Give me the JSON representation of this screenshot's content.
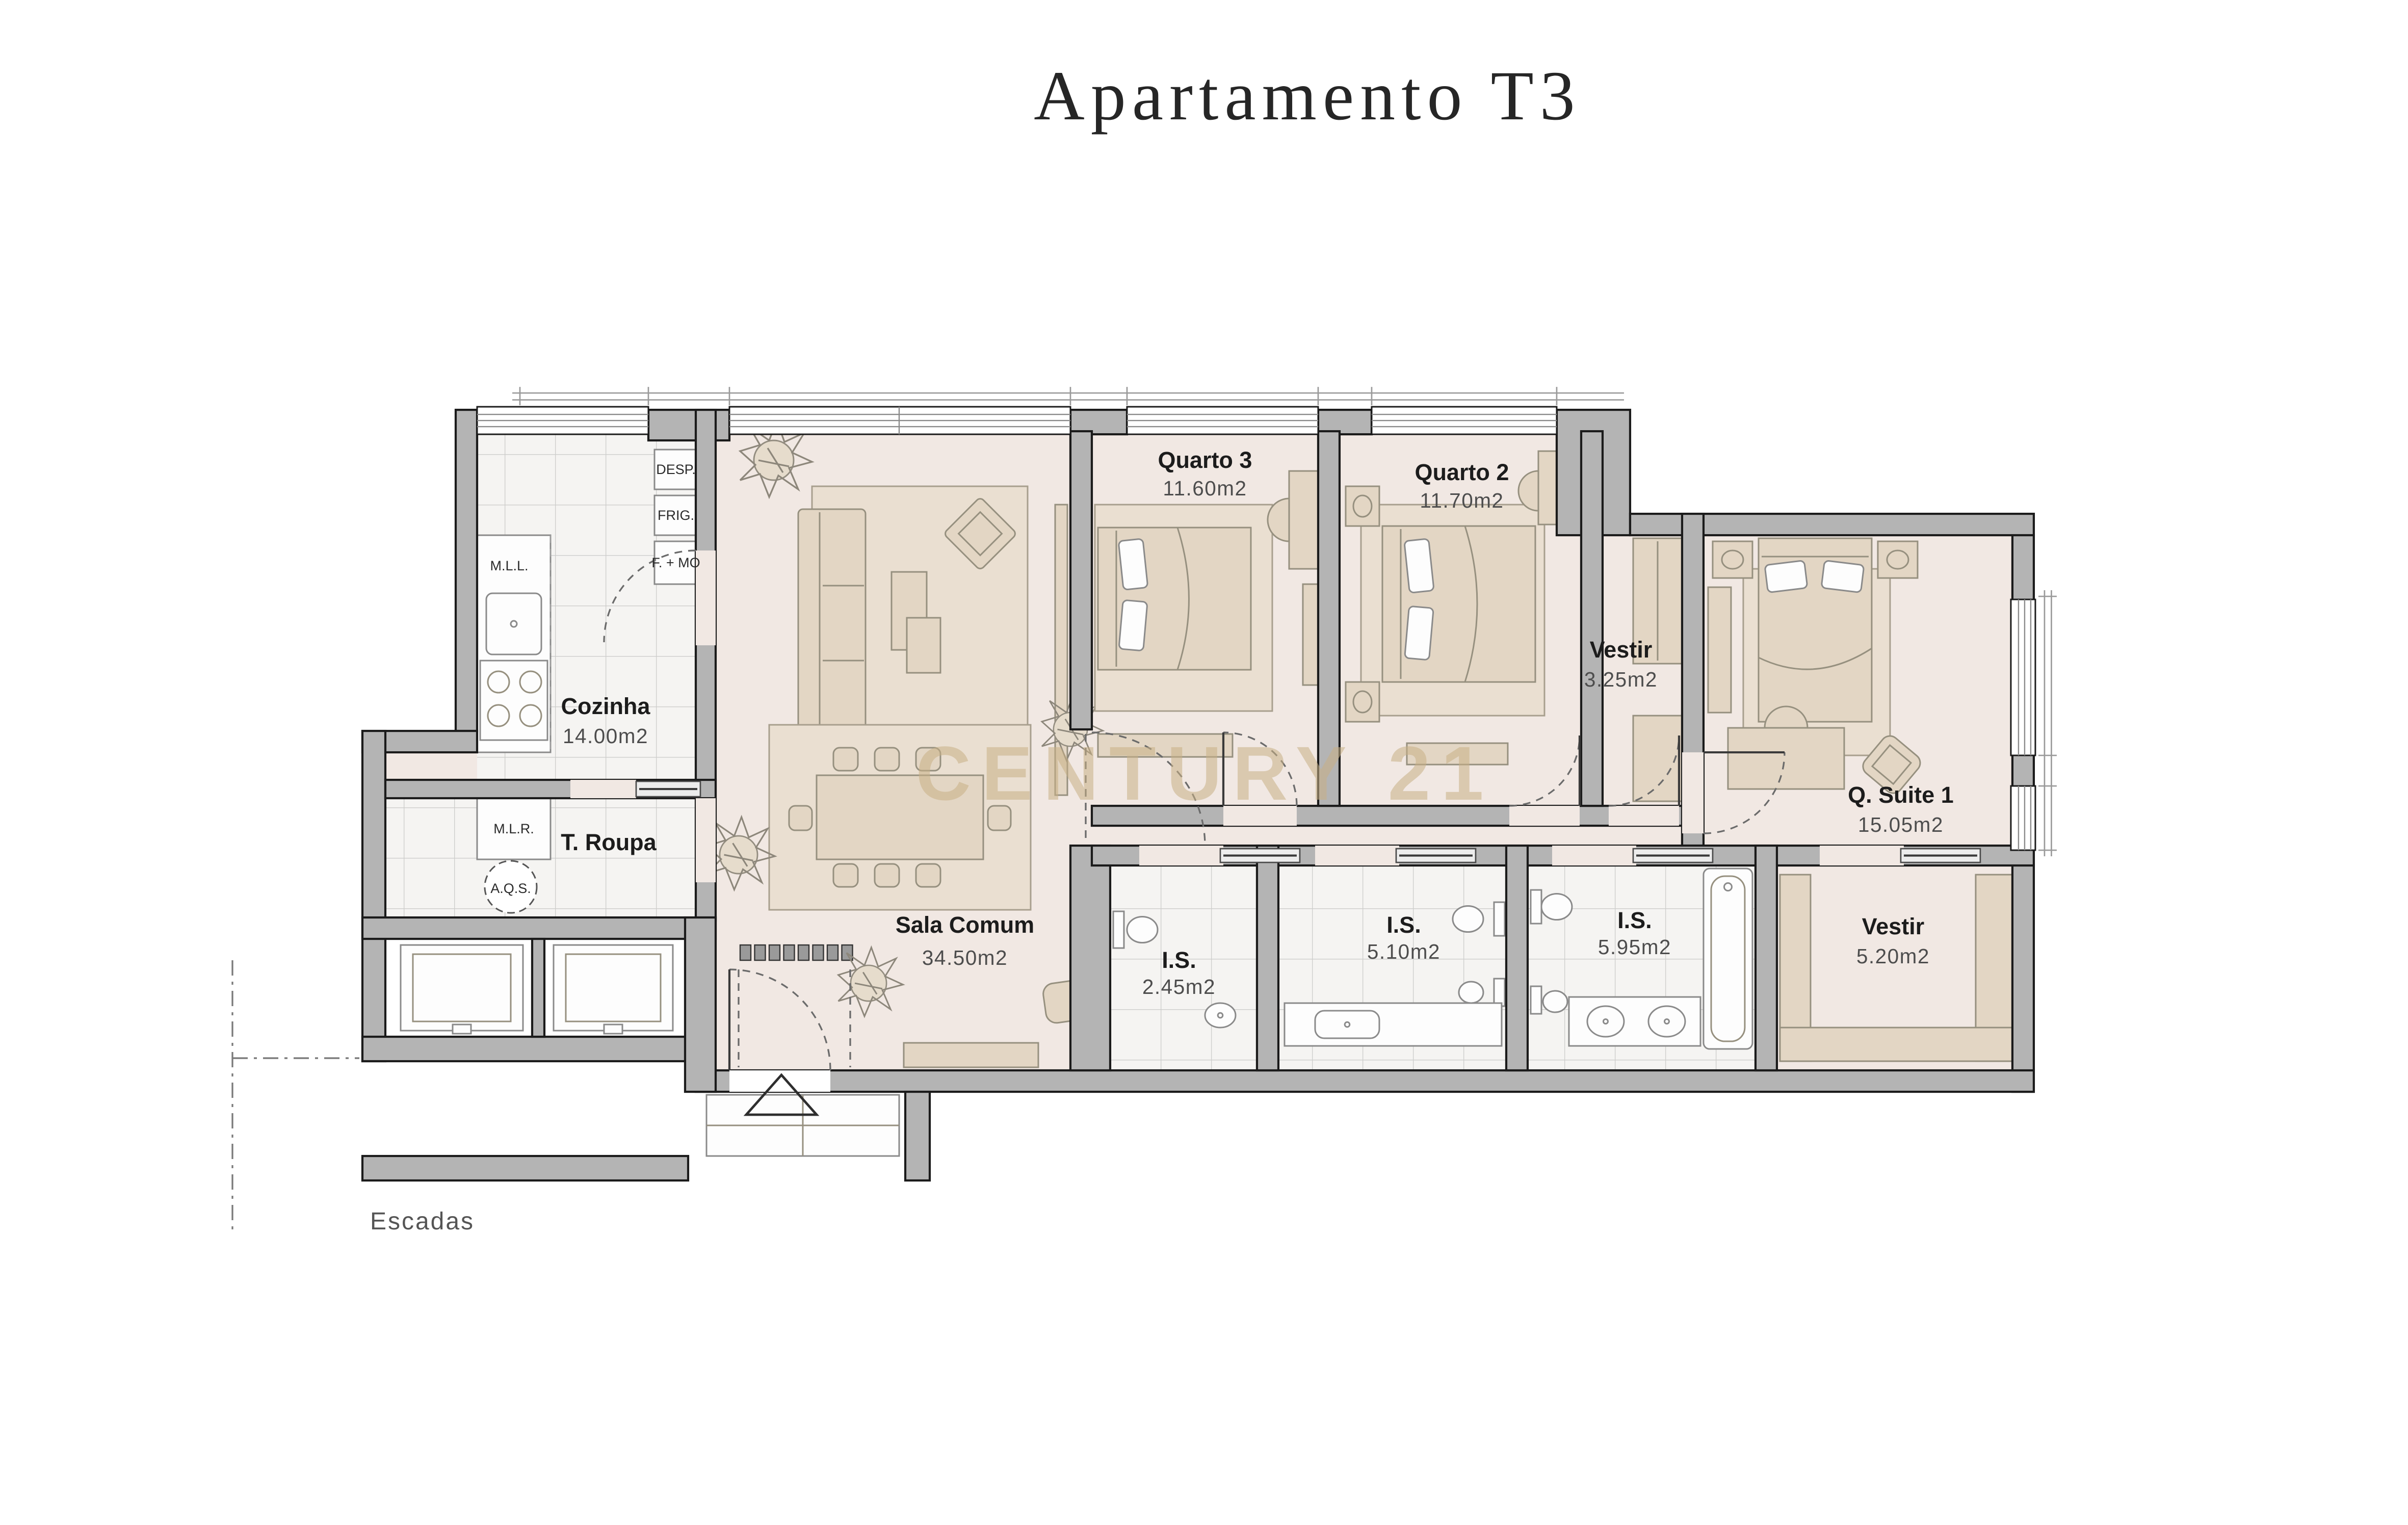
{
  "title": "Apartamento T3",
  "watermark": "CENTURY 21",
  "stairs_label": "Escadas",
  "rooms": [
    {
      "id": "cozinha",
      "name": "Cozinha",
      "area": "14.00m2"
    },
    {
      "id": "t_roupa",
      "name": "T. Roupa",
      "area": ""
    },
    {
      "id": "sala_comum",
      "name": "Sala Comum",
      "area": "34.50m2"
    },
    {
      "id": "quarto3",
      "name": "Quarto 3",
      "area": "11.60m2"
    },
    {
      "id": "quarto2",
      "name": "Quarto 2",
      "area": "11.70m2"
    },
    {
      "id": "vestir_q",
      "name": "Vestir",
      "area": "3.25m2"
    },
    {
      "id": "q_suite1",
      "name": "Q. Suite 1",
      "area": "15.05m2"
    },
    {
      "id": "vestir_suite",
      "name": "Vestir",
      "area": "5.20m2"
    },
    {
      "id": "is_hall",
      "name": "I.S.",
      "area": "2.45m2"
    },
    {
      "id": "is_quartos",
      "name": "I.S.",
      "area": "5.10m2"
    },
    {
      "id": "is_suite",
      "name": "I.S.",
      "area": "5.95m2"
    }
  ],
  "kitchen": {
    "desp": "DESP.",
    "frig": "FRIG.",
    "f_mo": "F. + MO",
    "mll": "M.L.L.",
    "mlr": "M.L.R.",
    "aqs": "A.Q.S."
  },
  "colors": {
    "wall_fill": "#b4b4b4",
    "wall_outline": "#1b1b1b",
    "floor": "#f1e8e3",
    "tile_floor": "#f5f4f2",
    "furniture": "#e3d6c4",
    "rug": "#eadfd1",
    "watermark": "#c8b085",
    "title_text": "#262626"
  }
}
